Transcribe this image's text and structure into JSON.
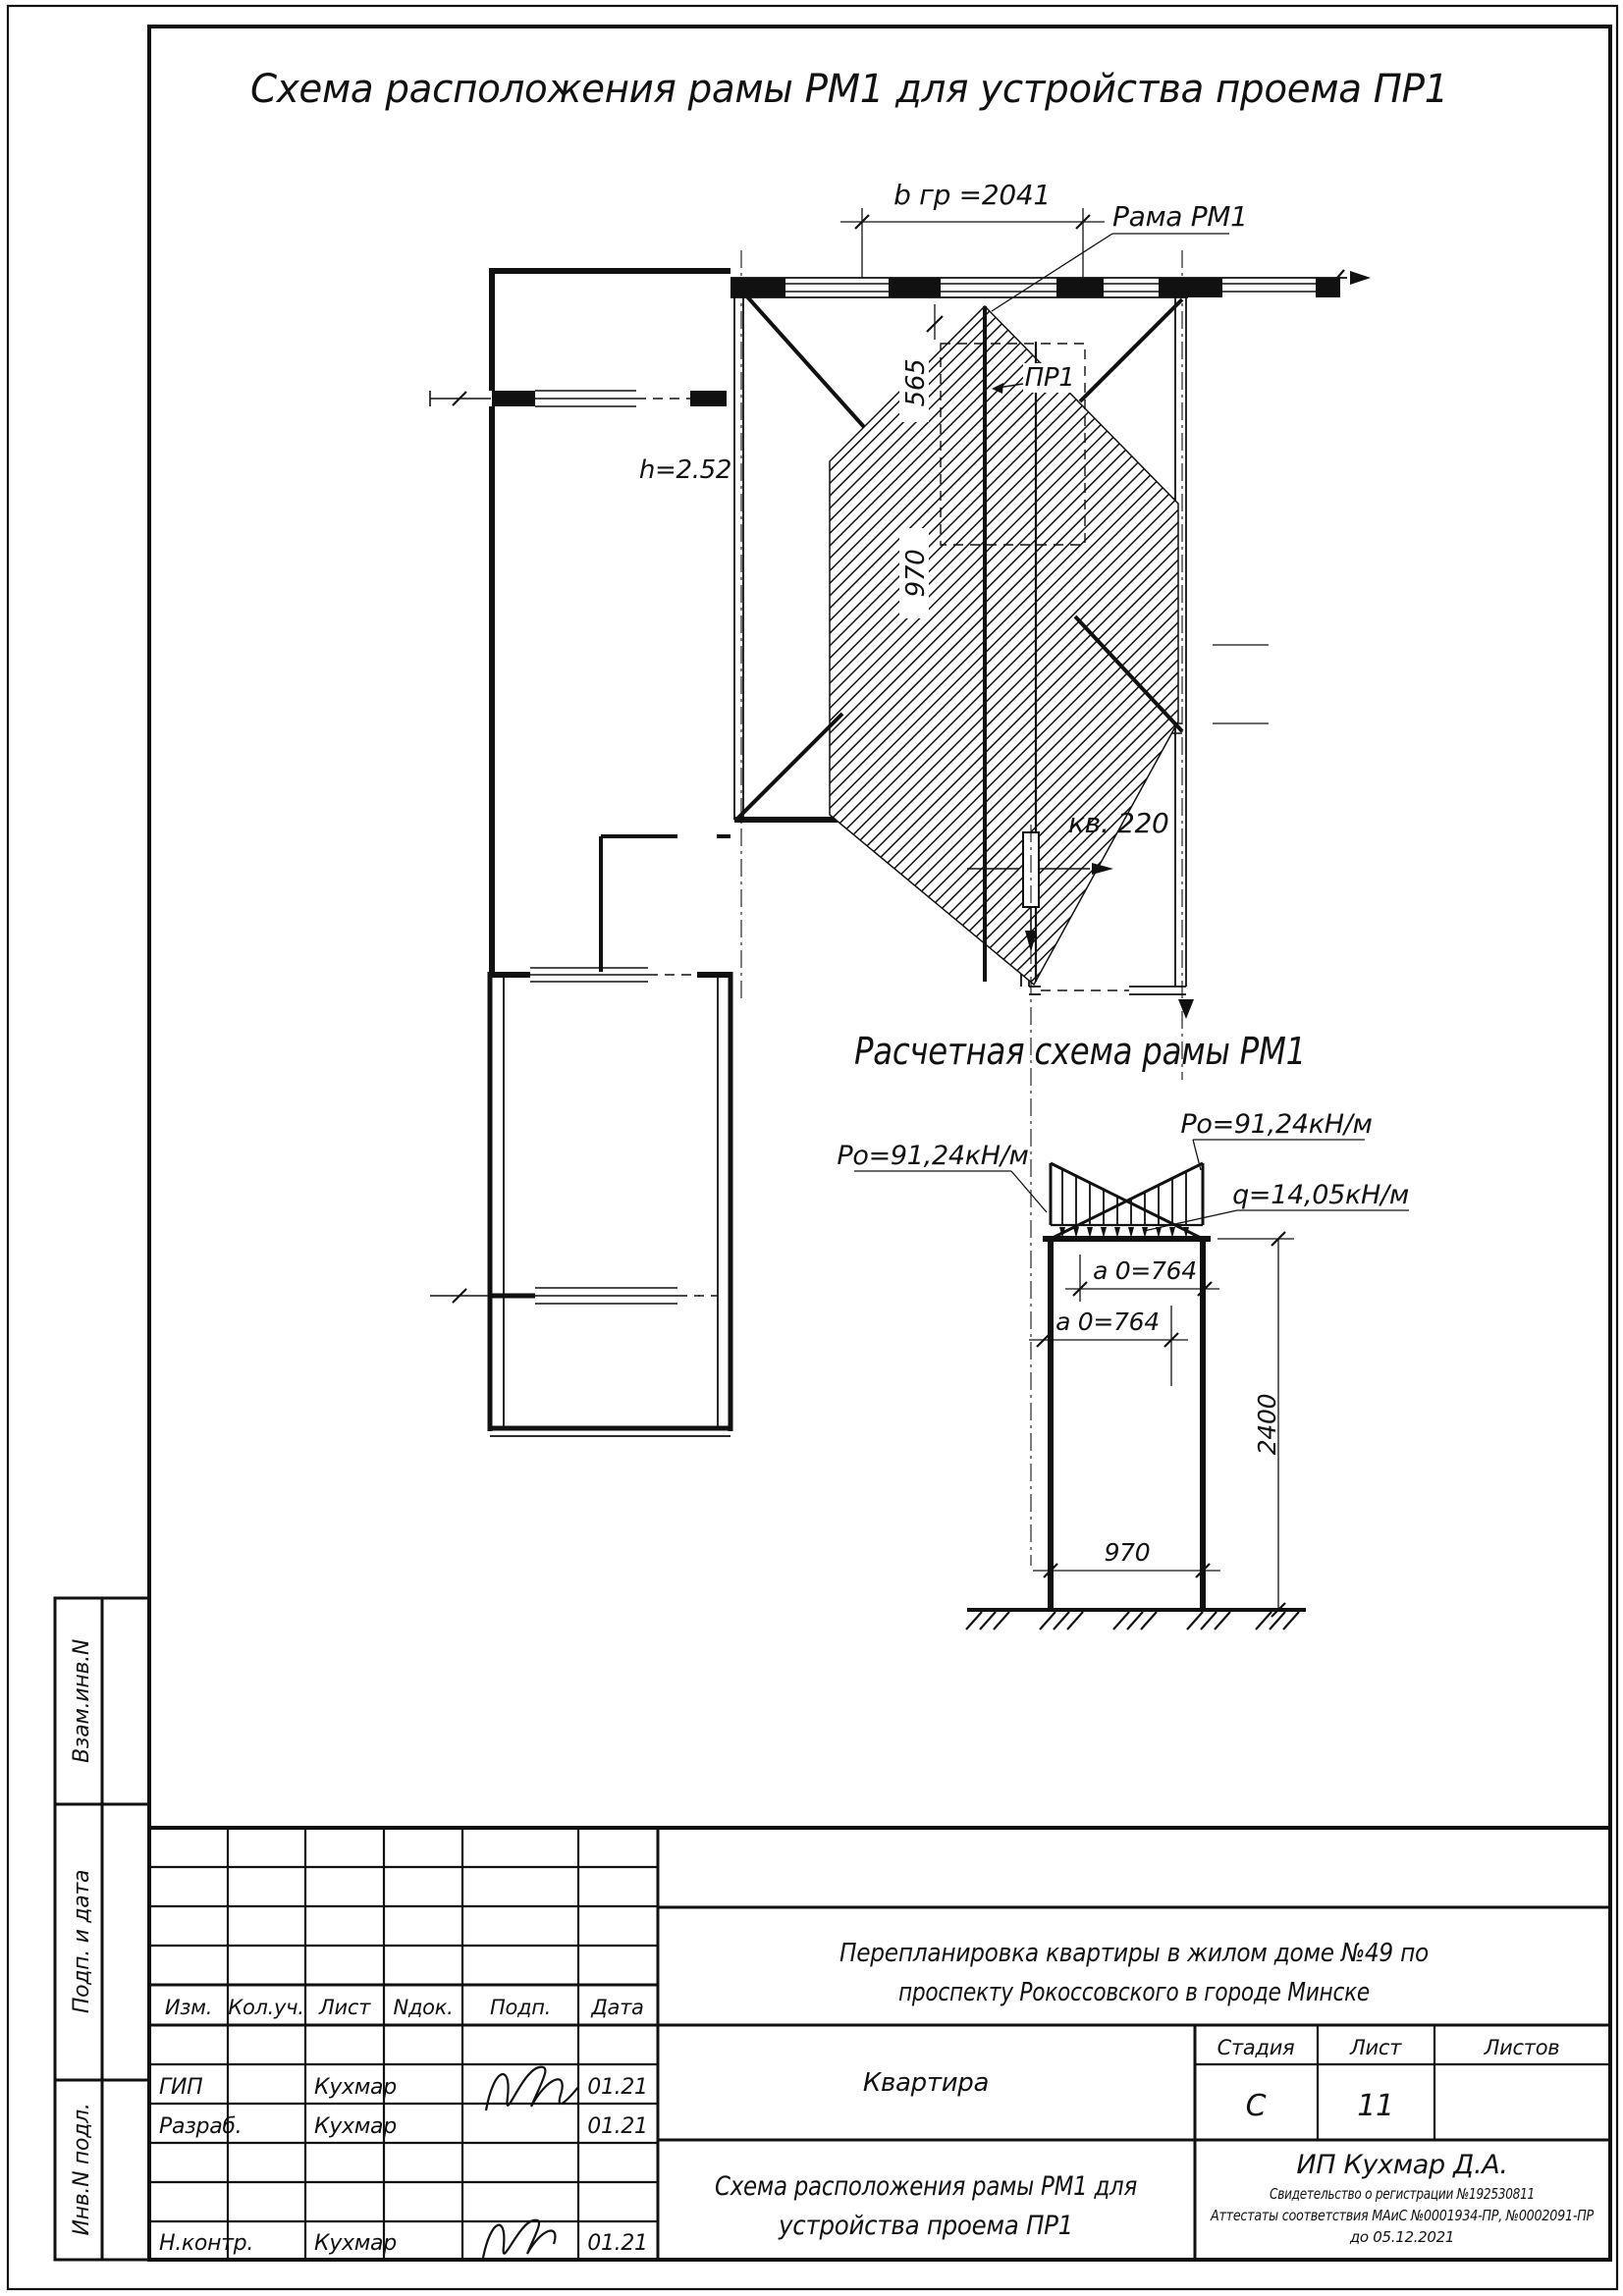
{
  "page": {
    "plan_title": "Схема расположения рамы РМ1 для устройства проема ПР1",
    "calc_title": "Расчетная схема рамы РМ1"
  },
  "plan": {
    "dim_width_top": "b гр =2041",
    "frame_leader": "Рама РМ1",
    "dim_565": "565",
    "dim_970": "970",
    "opening_label": "ПР1",
    "room_height": "h=2.52",
    "apartment": "кв. 220"
  },
  "calc": {
    "load_left": "Ро=91,24кН/м",
    "load_right": "Ро=91,24кН/м",
    "load_q": "q=14,05кН/м",
    "dim_a0_top": "а 0=764",
    "dim_a0_bottom": "а 0=764",
    "dim_height": "2400",
    "dim_width": "970"
  },
  "titleblock": {
    "header": [
      "Изм.",
      "Кол.уч.",
      "Лист",
      "Nдок.",
      "Подп.",
      "Дата"
    ],
    "staff": [
      {
        "role": "ГИП",
        "name": "Кухмар",
        "date": "01.21"
      },
      {
        "role": "Разраб.",
        "name": "Кухмар",
        "date": "01.21"
      },
      {
        "role": "Н.контр.",
        "name": "Кухмар",
        "date": "01.21"
      }
    ],
    "project_line1": "Перепланировка квартиры в жилом доме №49 по",
    "project_line2": "проспекту Рокоссовского в городе Минске",
    "object_name": "Квартира",
    "stage_label": "Стадия",
    "sheet_label": "Лист",
    "sheets_label": "Листов",
    "stage": "С",
    "sheet": "11",
    "doc_line1": "Схема расположения рамы РМ1 для",
    "doc_line2": "устройства проема ПР1",
    "company": "ИП Кухмар Д.А.",
    "cert_line1": "Свидетельство о регистрации №192530811",
    "cert_line2": "Аттестаты соответствия МАиС №0001934-ПР, №0002091-ПР",
    "cert_line3": "до 05.12.2021"
  },
  "side_stamp": [
    "Взам.инв.N",
    "Подп. и дата",
    "Инв.N подл."
  ],
  "colors": {
    "ink": "#111111",
    "paper": "#ffffff"
  }
}
